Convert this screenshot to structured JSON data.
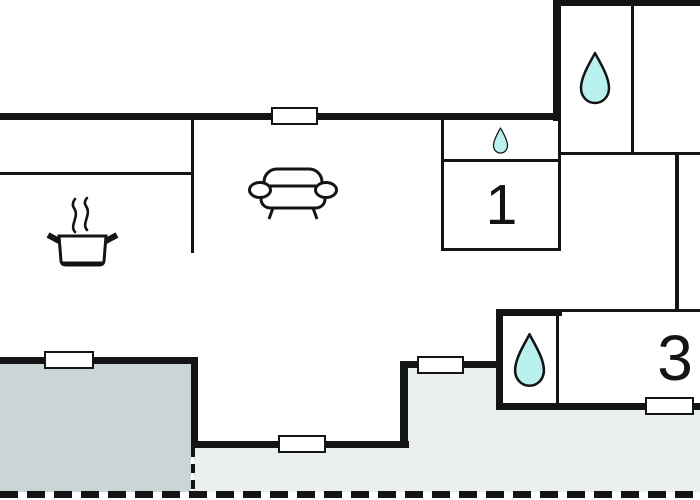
{
  "plan": {
    "type": "holiday-home floor plan",
    "rooms": [
      {
        "id": "bedroom-1",
        "label": "1"
      },
      {
        "id": "bedroom-3",
        "label": "3"
      }
    ],
    "icons": [
      {
        "name": "water-drop-icon",
        "meaning": "bathroom (upper right)"
      },
      {
        "name": "water-drop-icon",
        "meaning": "small wet room / toilet"
      },
      {
        "name": "water-drop-icon",
        "meaning": "bathroom (lower right)"
      },
      {
        "name": "sofa-icon",
        "meaning": "living room"
      },
      {
        "name": "cooking-pot-icon",
        "meaning": "kitchen"
      }
    ],
    "colors": {
      "wall": "#141414",
      "terrace_left": "#c9d5d7",
      "terrace_right": "#e9f0ee",
      "drop_fill": "#b9f1ee",
      "steam": "#8c8c8c",
      "background": "#ffffff"
    }
  }
}
